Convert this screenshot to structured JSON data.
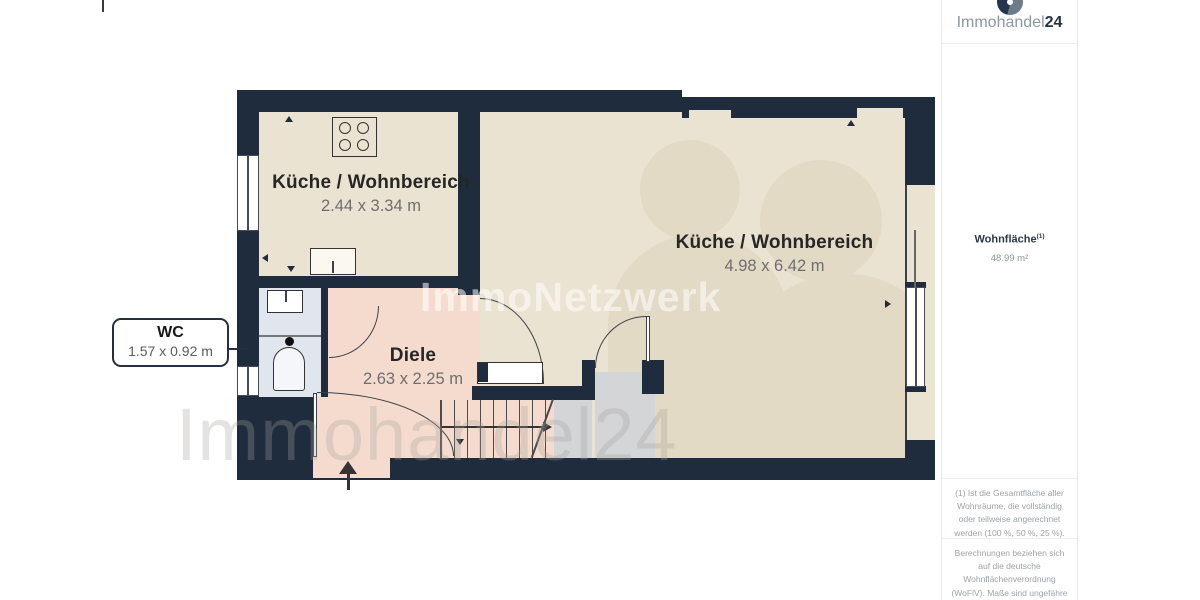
{
  "branding": {
    "logo_text_primary": "Immohandel",
    "logo_text_suffix": "24"
  },
  "sidebar": {
    "area_label": "Wohnfläche",
    "area_sup": "(1)",
    "area_value": "48.99 m²",
    "note1": "(1) Ist die Gesamtfläche aller Wohnräume, die vollständig oder teilweise angerechnet werden (100 %, 50 %, 25 %).",
    "note2": "Berechnungen beziehen sich auf die deutsche Wohnflächenverordnung (WoFlV). Maße sind ungefähre Angaben und nicht maßstabsgetreu. Dieser Grundriss dient nur zur"
  },
  "floorplan": {
    "rooms": [
      {
        "name": "Küche / Wohnbereich",
        "dimensions": "2.44 x 3.34 m"
      },
      {
        "name": "Küche / Wohnbereich",
        "dimensions": "4.98 x 6.42 m"
      },
      {
        "name": "Diele",
        "dimensions": "2.63 x 2.25 m"
      },
      {
        "name": "WC",
        "dimensions": "1.57 x 0.92 m"
      }
    ],
    "watermark_center": "ImmoNetzwerk",
    "watermark_bottom": "Immohandel24"
  },
  "colors": {
    "wall": "#1f2c3d",
    "floor": "#ebe3d1",
    "floor_shadow": "#e3dac5",
    "diele": "#f4dbce",
    "wc_floor": "#e0e5ee",
    "storage": "#d4d5d7",
    "accent_navy": "#24364b",
    "logo_gray": "#6e7b88"
  }
}
